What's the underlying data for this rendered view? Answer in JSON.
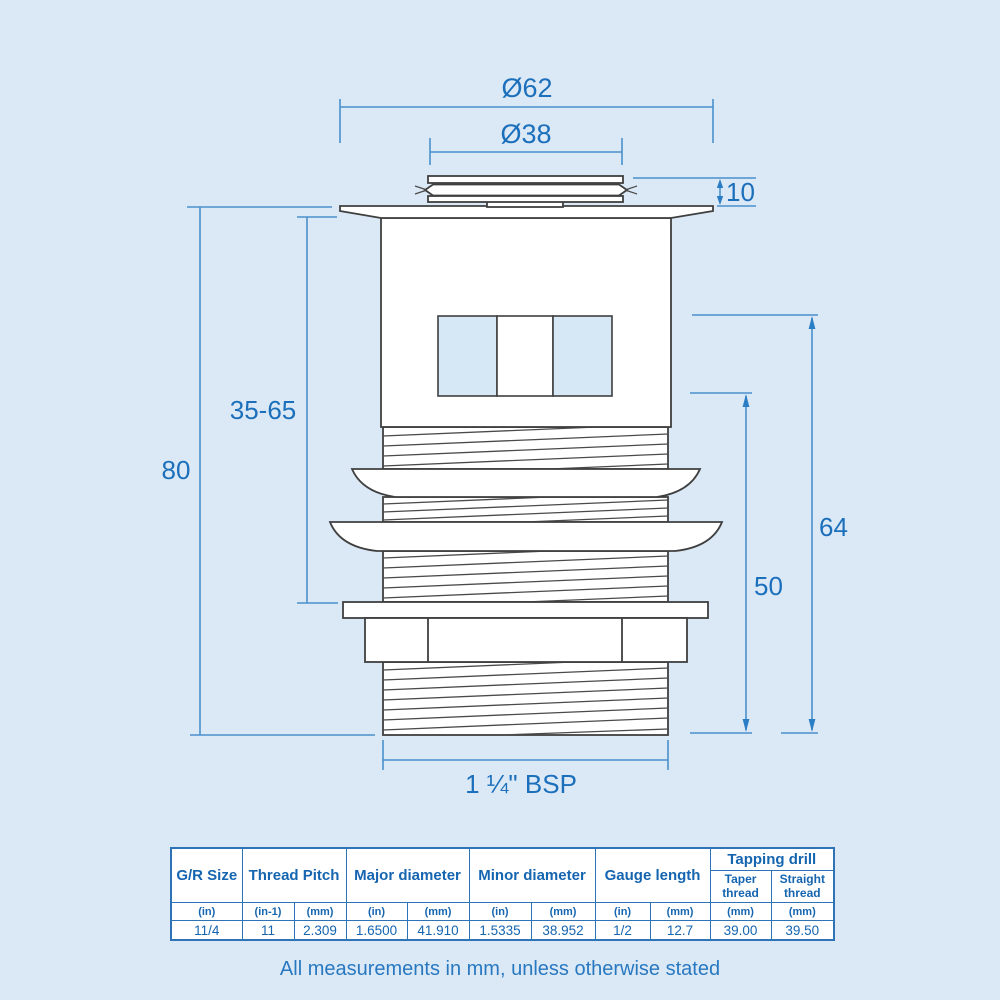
{
  "drawing": {
    "dimensions": {
      "outer_diameter": "Ø62",
      "inner_diameter": "Ø38",
      "cap_height": "10",
      "adjust_range": "35-65",
      "total_height": "80",
      "upper_thread_span": "64",
      "lower_thread_span": "50",
      "thread_size": "1 ¼\" BSP"
    }
  },
  "table": {
    "group_headers": [
      "G/R Size",
      "Thread Pitch",
      "Major diameter",
      "Minor diameter",
      "Gauge length",
      "Tapping drill"
    ],
    "sub_headers": [
      "Taper thread",
      "Straight thread"
    ],
    "units": [
      "(in)",
      "(in-1)",
      "(mm)",
      "(in)",
      "(mm)",
      "(in)",
      "(mm)",
      "(in)",
      "(mm)",
      "(mm)",
      "(mm)"
    ],
    "values": [
      "11/4",
      "11",
      "2.309",
      "1.6500",
      "41.910",
      "1.5335",
      "38.952",
      "1/2",
      "12.7",
      "39.00",
      "39.50"
    ]
  },
  "footnote": "All measurements in mm, unless otherwise stated",
  "colors": {
    "background": "#dbe9f6",
    "dimension_line": "#4a90cd",
    "dimension_text": "#1b6fbb",
    "table_border": "#2d73b5",
    "table_text": "#1565b0",
    "drawing_outline": "#3f3f3f",
    "slot_fill": "#d6e7f6"
  }
}
